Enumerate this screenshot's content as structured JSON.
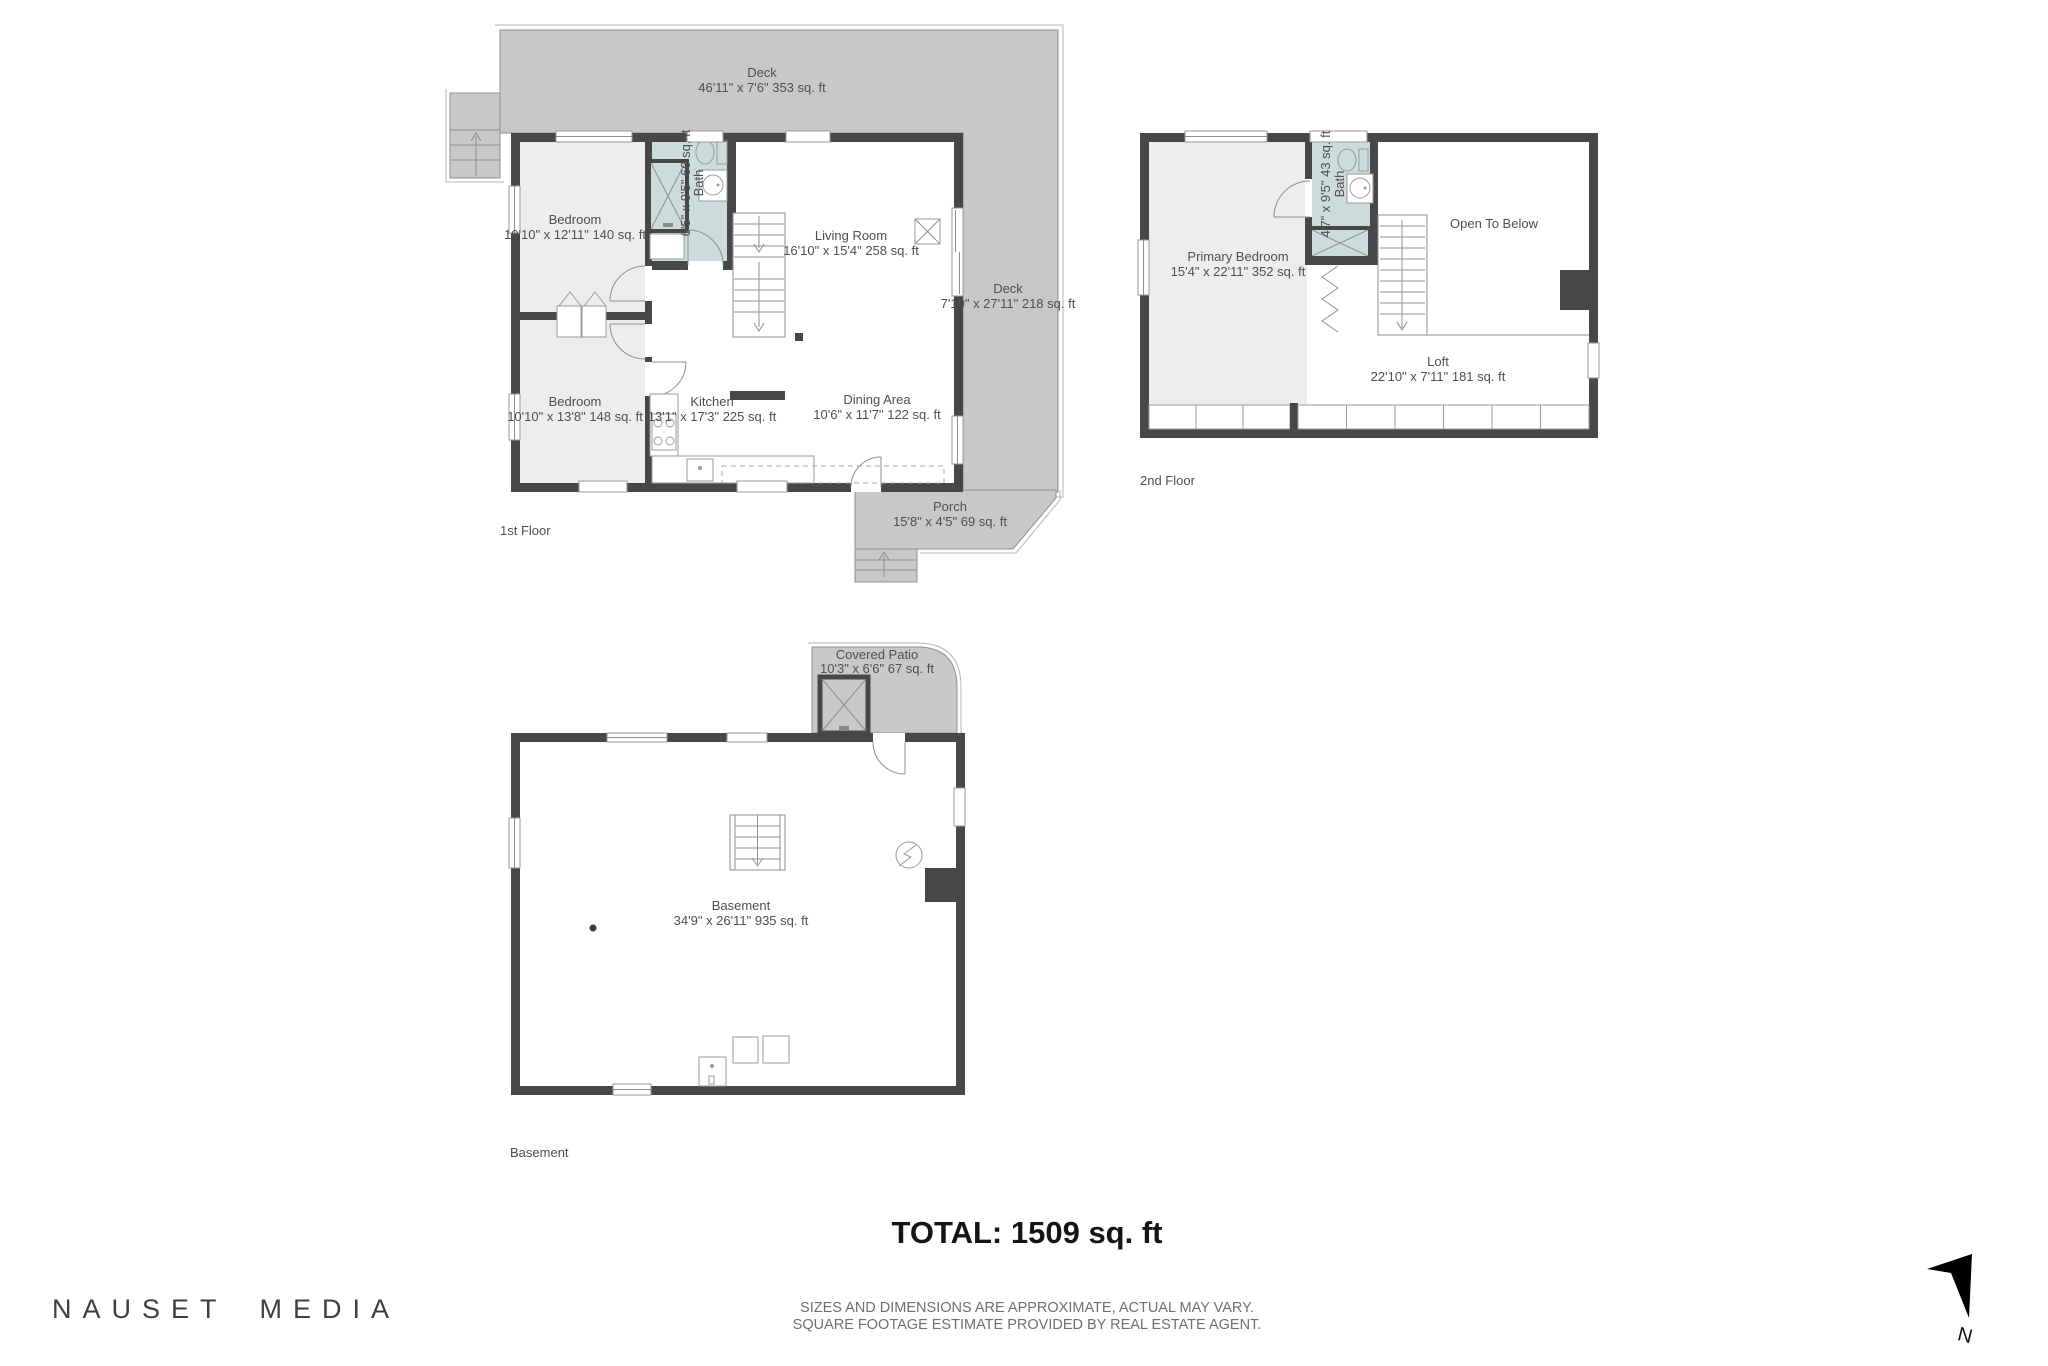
{
  "colors": {
    "wall": "#474747",
    "deck": "#c8c8c8",
    "room_fill": "#ededed",
    "bath_fill": "#ccdcdc",
    "label_text": "#4f4f4f"
  },
  "floors": {
    "first": {
      "floor_label": "1st Floor",
      "deck_top": {
        "name": "Deck",
        "dims": "46'11\" x 7'6\" 353 sq. ft"
      },
      "deck_right": {
        "name": "Deck",
        "dims": "7'10\" x 27'11\" 218 sq. ft"
      },
      "bedroom1": {
        "name": "Bedroom",
        "dims": "10'10\" x 12'11\" 140 sq. ft"
      },
      "bath": {
        "name": "Bath",
        "dims": "6'5\" x 9'5\" 60 sq. ft"
      },
      "living": {
        "name": "Living Room",
        "dims": "16'10\" x 15'4\" 258 sq. ft"
      },
      "bedroom2": {
        "name": "Bedroom",
        "dims": "10'10\" x 13'8\" 148 sq. ft"
      },
      "kitchen": {
        "name": "Kitchen",
        "dims": "13'1\" x 17'3\" 225 sq. ft"
      },
      "dining": {
        "name": "Dining Area",
        "dims": "10'6\" x 11'7\" 122 sq. ft"
      },
      "porch": {
        "name": "Porch",
        "dims": "15'8\" x 4'5\" 69 sq. ft"
      }
    },
    "second": {
      "floor_label": "2nd Floor",
      "primary_bedroom": {
        "name": "Primary Bedroom",
        "dims": "15'4\" x 22'11\" 352 sq. ft"
      },
      "bath": {
        "name": "Bath",
        "dims": "4'7\" x 9'5\" 43 sq. ft"
      },
      "open_to_below": {
        "name": "Open To Below"
      },
      "loft": {
        "name": "Loft",
        "dims": "22'10\" x 7'11\" 181 sq. ft"
      }
    },
    "basement": {
      "floor_label": "Basement",
      "covered_patio": {
        "name": "Covered Patio",
        "dims": "10'3\" x 6'6\" 67 sq. ft"
      },
      "basement_room": {
        "name": "Basement",
        "dims": "34'9\" x 26'11\" 935 sq. ft"
      }
    }
  },
  "footer": {
    "total": "TOTAL: 1509 sq. ft",
    "disclaimer_line1": "SIZES AND DIMENSIONS ARE APPROXIMATE, ACTUAL MAY VARY.",
    "disclaimer_line2": "SQUARE FOOTAGE ESTIMATE PROVIDED BY REAL ESTATE AGENT.",
    "brand": "NAUSET MEDIA"
  },
  "compass": {
    "label": "N"
  }
}
